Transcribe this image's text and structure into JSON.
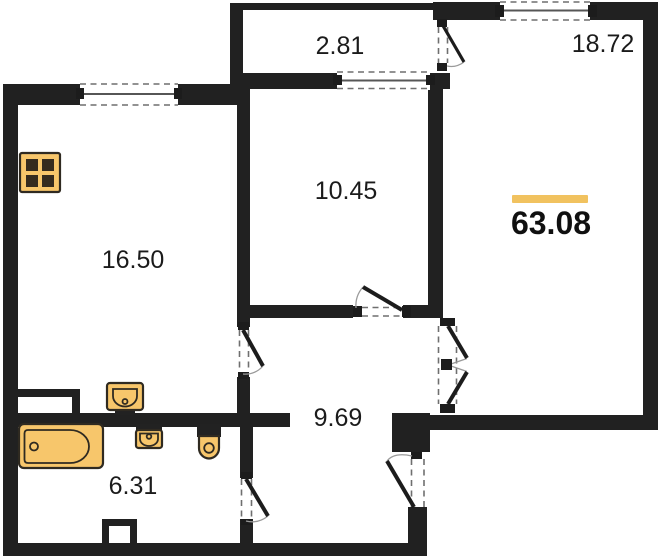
{
  "plan": {
    "total": {
      "area": "63.08"
    },
    "rooms": {
      "balcony": {
        "area": "2.81"
      },
      "right_room": {
        "area": "18.72"
      },
      "middle_room": {
        "area": "10.45"
      },
      "left_room": {
        "area": "16.50"
      },
      "hallway": {
        "area": "9.69"
      },
      "bathroom": {
        "area": "6.31"
      }
    },
    "fixtures": [
      "stove-icon",
      "kitchen-sink-icon",
      "washbasin-icon",
      "toilet-icon",
      "bathtub-icon"
    ],
    "colors": {
      "wall": "#212121",
      "fixture_fill": "#f7c66b",
      "fixture_stroke": "#2f2a21",
      "accent_bar": "#f1c25f"
    }
  }
}
